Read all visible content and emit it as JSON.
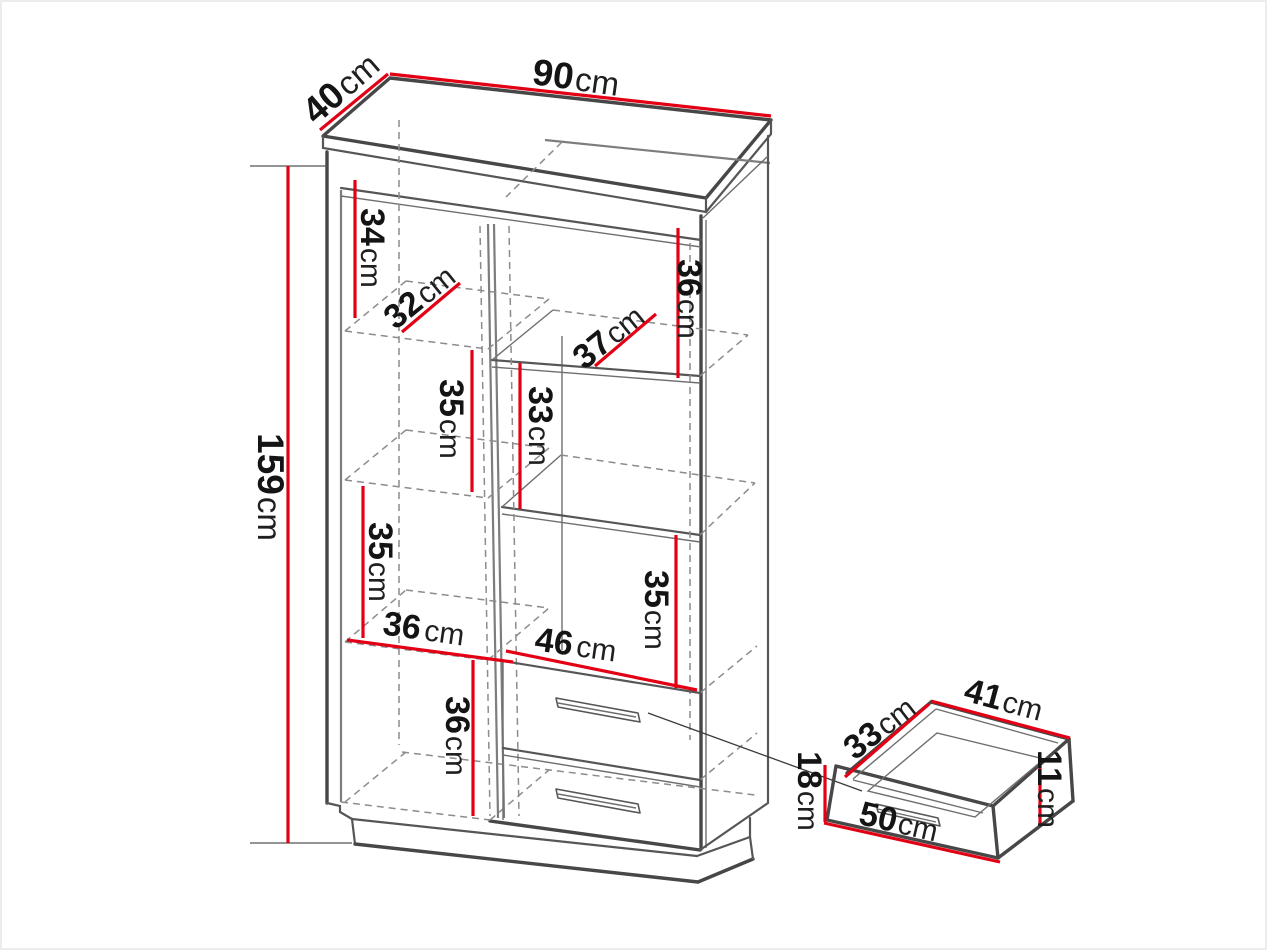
{
  "diagram": {
    "unit_default": "cm",
    "colors": {
      "dimension": "#e30015",
      "outline": "#474747",
      "hidden": "#8c8c8c",
      "text": "#141414"
    }
  },
  "dimensions": {
    "cabinet": [
      {
        "name": "width",
        "value": "90",
        "unit": "cm"
      },
      {
        "name": "depth",
        "value": "40",
        "unit": "cm"
      },
      {
        "name": "height",
        "value": "159",
        "unit": "cm"
      },
      {
        "name": "left-top-compartment-height",
        "value": "34",
        "unit": "cm"
      },
      {
        "name": "left-top-shelf-depth",
        "value": "32",
        "unit": "cm"
      },
      {
        "name": "right-top-compartment-height",
        "value": "36",
        "unit": "cm"
      },
      {
        "name": "right-top-shelf-depth",
        "value": "37",
        "unit": "cm"
      },
      {
        "name": "left-middle-compartment-height",
        "value": "35",
        "unit": "cm"
      },
      {
        "name": "center-compartment-height",
        "value": "33",
        "unit": "cm"
      },
      {
        "name": "left-lower-compartment-height",
        "value": "35",
        "unit": "cm"
      },
      {
        "name": "left-shelf-width",
        "value": "36",
        "unit": "cm"
      },
      {
        "name": "right-lower-compartment-height",
        "value": "35",
        "unit": "cm"
      },
      {
        "name": "right-shelf-width",
        "value": "46",
        "unit": "cm"
      },
      {
        "name": "left-bottom-compartment-height",
        "value": "36",
        "unit": "cm"
      }
    ],
    "drawer": [
      {
        "name": "drawer-depth",
        "value": "33",
        "unit": "cm"
      },
      {
        "name": "drawer-width",
        "value": "41",
        "unit": "cm"
      },
      {
        "name": "drawer-side-height",
        "value": "11",
        "unit": "cm"
      },
      {
        "name": "drawer-front-height",
        "value": "18",
        "unit": "cm"
      },
      {
        "name": "drawer-front-width",
        "value": "50",
        "unit": "cm"
      }
    ]
  }
}
